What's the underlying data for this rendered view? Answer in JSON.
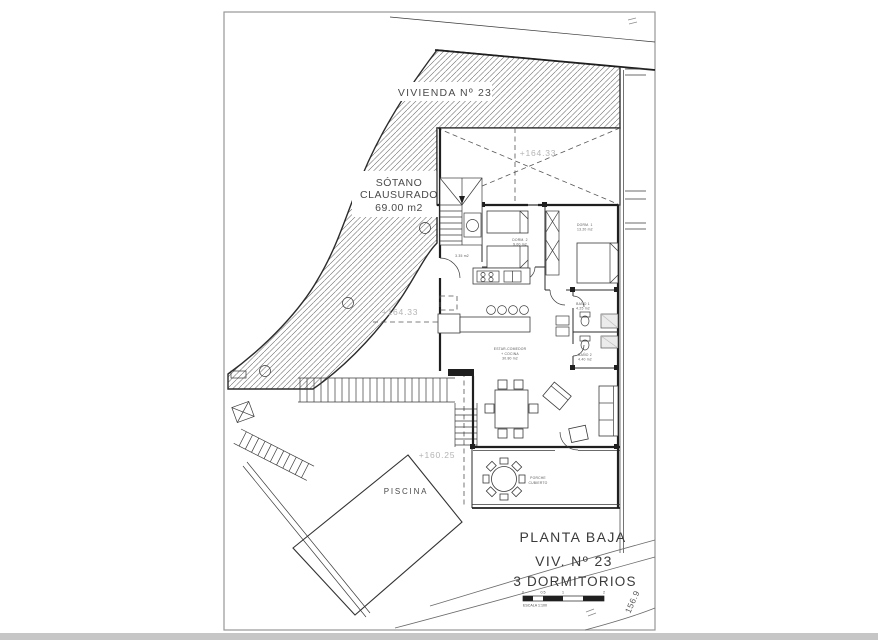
{
  "drawing": {
    "plot_label": "VIVIENDA Nº 23",
    "basement": {
      "l1": "SÓTANO",
      "l2": "CLAUSURADO",
      "l3": "69.00 m2"
    },
    "elevations": {
      "void": "+164.33",
      "terrace": "+164.33",
      "pool_terrace": "+160.25"
    },
    "rooms": {
      "dorm1": {
        "name": "DORM. 1",
        "area": "13.20 m2"
      },
      "dorm2": {
        "name": "DORM. 2",
        "area": "9.00 m2"
      },
      "bano1": {
        "name": "BAÑO 1",
        "area": "4.25 m2"
      },
      "bano2": {
        "name": "BAÑO 2",
        "area": "4.40 m2"
      },
      "estar": {
        "l1": "ESTAR-COMEDOR",
        "l2": "+ COCINA",
        "l3": "30.80 m2"
      },
      "stair_area": "3.35 m2",
      "porche": {
        "l1": "PORCHE",
        "l2": "CUBIERTO"
      },
      "piscina": "PISCINA"
    },
    "title_block": {
      "line1": "PLANTA BAJA",
      "line2": "VIV. Nº 23",
      "line3": "3 DORMITORIOS"
    },
    "scale_bar": {
      "ticks": [
        "0",
        "0.5",
        "1",
        "2"
      ],
      "caption": "ESCALA 1:100"
    },
    "contour_elevation": "156.9",
    "colors": {
      "ink": "#2b2b2b",
      "wall": "#1f1f1f",
      "gray_label": "#b4b4b4",
      "room_label": "#5a5a5a",
      "frame": "#979797",
      "hatch": "#5f5f5f",
      "fixture_fill": "#ebebeb",
      "bottom_strip": "#c6c6c6"
    }
  }
}
